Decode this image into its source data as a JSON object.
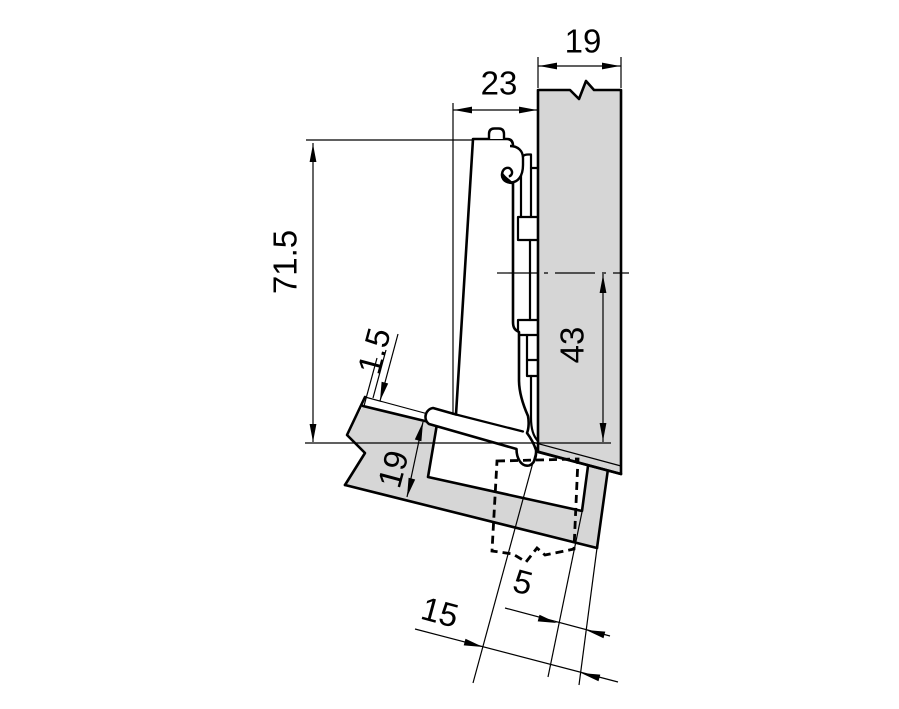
{
  "drawing": {
    "type": "technical-dimension-drawing",
    "subject": "concealed cabinet hinge mounted between a cabinet side panel and an angled door"
  },
  "colors": {
    "background": "#ffffff",
    "panel_fill": "#d6d6d6",
    "line": "#000000"
  },
  "dimensions": {
    "panel_thickness": {
      "label": "19"
    },
    "arm_clearance": {
      "label": "23"
    },
    "overall_height": {
      "label": "71.5"
    },
    "gap": {
      "label": "1.5"
    },
    "door_thickness": {
      "label": "19"
    },
    "plate_distance": {
      "label": "43"
    },
    "cup_edge_distance": {
      "label": "5"
    },
    "edge_distance": {
      "label": "15"
    }
  }
}
